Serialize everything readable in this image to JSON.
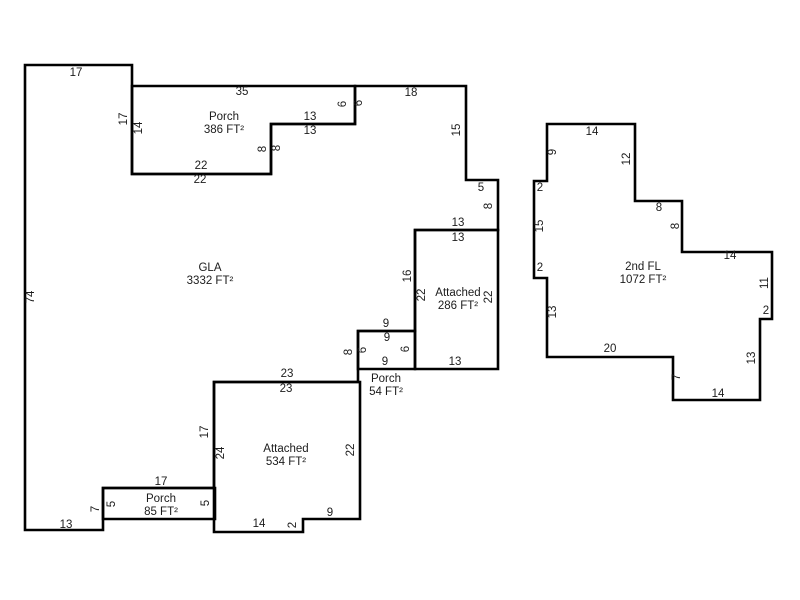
{
  "canvas": {
    "width": 800,
    "height": 600,
    "background_color": "#ffffff",
    "line_color": "#000000",
    "line_width": 2.6,
    "text_color": "#1c1c1c",
    "area_label_line_height": 13
  },
  "sketch": {
    "description": "Appraisal floor plan sketch with labeled wall dimensions in feet",
    "polygons": [
      {
        "id": "gla",
        "area_label": {
          "lines": [
            "GLA",
            "3332 FT²"
          ],
          "x": 210,
          "y": 268
        },
        "points": [
          [
            25,
            65
          ],
          [
            132,
            65
          ],
          [
            132,
            174
          ],
          [
            271,
            174
          ],
          [
            271,
            124
          ],
          [
            355,
            124
          ],
          [
            355,
            86
          ],
          [
            466,
            86
          ],
          [
            466,
            180
          ],
          [
            498,
            180
          ],
          [
            498,
            230
          ],
          [
            415,
            230
          ],
          [
            415,
            331
          ],
          [
            358,
            331
          ],
          [
            358,
            382
          ],
          [
            214,
            382
          ],
          [
            214,
            488
          ],
          [
            103,
            488
          ],
          [
            103,
            530
          ],
          [
            25,
            530
          ]
        ]
      },
      {
        "id": "porch-386",
        "area_label": {
          "lines": [
            "Porch",
            "386 FT²"
          ],
          "x": 224,
          "y": 117
        },
        "points": [
          [
            132,
            86
          ],
          [
            355,
            86
          ],
          [
            355,
            124
          ],
          [
            271,
            124
          ],
          [
            271,
            174
          ],
          [
            132,
            174
          ]
        ]
      },
      {
        "id": "attached-286",
        "area_label": {
          "lines": [
            "Attached",
            "286 FT²"
          ],
          "x": 458,
          "y": 293
        },
        "points": [
          [
            415,
            230
          ],
          [
            498,
            230
          ],
          [
            498,
            369
          ],
          [
            415,
            369
          ]
        ]
      },
      {
        "id": "porch-54",
        "area_label": {
          "lines": [
            "Porch",
            "54 FT²"
          ],
          "x": 386,
          "y": 379
        },
        "points": [
          [
            358,
            331
          ],
          [
            415,
            331
          ],
          [
            415,
            369
          ],
          [
            358,
            369
          ]
        ]
      },
      {
        "id": "attached-534",
        "area_label": {
          "lines": [
            "Attached",
            "534 FT²"
          ],
          "x": 286,
          "y": 449
        },
        "points": [
          [
            214,
            382
          ],
          [
            360,
            382
          ],
          [
            360,
            519
          ],
          [
            303,
            519
          ],
          [
            303,
            532
          ],
          [
            214,
            532
          ]
        ]
      },
      {
        "id": "porch-85",
        "area_label": {
          "lines": [
            "Porch",
            "85 FT²"
          ],
          "x": 161,
          "y": 499
        },
        "points": [
          [
            103,
            488
          ],
          [
            215,
            488
          ],
          [
            215,
            519
          ],
          [
            103,
            519
          ]
        ]
      },
      {
        "id": "second-floor",
        "area_label": {
          "lines": [
            "2nd FL",
            "1072 FT²"
          ],
          "x": 643,
          "y": 267
        },
        "points": [
          [
            547,
            124
          ],
          [
            635,
            124
          ],
          [
            635,
            201
          ],
          [
            682,
            201
          ],
          [
            682,
            252
          ],
          [
            772,
            252
          ],
          [
            772,
            319
          ],
          [
            760,
            319
          ],
          [
            760,
            400
          ],
          [
            673,
            400
          ],
          [
            673,
            357
          ],
          [
            547,
            357
          ],
          [
            547,
            278
          ],
          [
            534,
            278
          ],
          [
            534,
            181
          ],
          [
            547,
            181
          ]
        ]
      }
    ],
    "dimension_labels": [
      {
        "text": "17",
        "x": 76,
        "y": 73,
        "rotated": false
      },
      {
        "text": "74",
        "x": 31,
        "y": 297,
        "rotated": true
      },
      {
        "text": "17",
        "x": 124,
        "y": 119,
        "rotated": true
      },
      {
        "text": "14",
        "x": 139,
        "y": 128,
        "rotated": true
      },
      {
        "text": "35",
        "x": 242,
        "y": 92,
        "rotated": false
      },
      {
        "text": "13",
        "x": 310,
        "y": 117,
        "rotated": false
      },
      {
        "text": "13",
        "x": 310,
        "y": 131,
        "rotated": false
      },
      {
        "text": "6",
        "x": 343,
        "y": 104,
        "rotated": true
      },
      {
        "text": "6",
        "x": 359,
        "y": 103,
        "rotated": true
      },
      {
        "text": "8",
        "x": 263,
        "y": 149,
        "rotated": true
      },
      {
        "text": "8",
        "x": 277,
        "y": 148,
        "rotated": true
      },
      {
        "text": "22",
        "x": 201,
        "y": 166,
        "rotated": false
      },
      {
        "text": "22",
        "x": 200,
        "y": 180,
        "rotated": false
      },
      {
        "text": "18",
        "x": 411,
        "y": 93,
        "rotated": false
      },
      {
        "text": "15",
        "x": 457,
        "y": 130,
        "rotated": true
      },
      {
        "text": "5",
        "x": 481,
        "y": 188,
        "rotated": false
      },
      {
        "text": "8",
        "x": 489,
        "y": 206,
        "rotated": true
      },
      {
        "text": "13",
        "x": 458,
        "y": 223,
        "rotated": false
      },
      {
        "text": "13",
        "x": 458,
        "y": 238,
        "rotated": false
      },
      {
        "text": "16",
        "x": 408,
        "y": 276,
        "rotated": true
      },
      {
        "text": "22",
        "x": 422,
        "y": 295,
        "rotated": true
      },
      {
        "text": "22",
        "x": 489,
        "y": 297,
        "rotated": true
      },
      {
        "text": "9",
        "x": 386,
        "y": 324,
        "rotated": false
      },
      {
        "text": "9",
        "x": 387,
        "y": 338,
        "rotated": false
      },
      {
        "text": "8",
        "x": 349,
        "y": 352,
        "rotated": true
      },
      {
        "text": "6",
        "x": 363,
        "y": 350,
        "rotated": true
      },
      {
        "text": "6",
        "x": 406,
        "y": 349,
        "rotated": true
      },
      {
        "text": "9",
        "x": 385,
        "y": 362,
        "rotated": false
      },
      {
        "text": "13",
        "x": 455,
        "y": 362,
        "rotated": false
      },
      {
        "text": "23",
        "x": 287,
        "y": 374,
        "rotated": false
      },
      {
        "text": "23",
        "x": 286,
        "y": 389,
        "rotated": false
      },
      {
        "text": "17",
        "x": 205,
        "y": 432,
        "rotated": true
      },
      {
        "text": "24",
        "x": 221,
        "y": 453,
        "rotated": true
      },
      {
        "text": "22",
        "x": 351,
        "y": 450,
        "rotated": true
      },
      {
        "text": "9",
        "x": 330,
        "y": 513,
        "rotated": false
      },
      {
        "text": "2",
        "x": 293,
        "y": 525,
        "rotated": true
      },
      {
        "text": "14",
        "x": 259,
        "y": 524,
        "rotated": false
      },
      {
        "text": "17",
        "x": 161,
        "y": 482,
        "rotated": false
      },
      {
        "text": "7",
        "x": 96,
        "y": 509,
        "rotated": true
      },
      {
        "text": "5",
        "x": 112,
        "y": 504,
        "rotated": true
      },
      {
        "text": "5",
        "x": 206,
        "y": 503,
        "rotated": true
      },
      {
        "text": "13",
        "x": 66,
        "y": 525,
        "rotated": false
      },
      {
        "text": "14",
        "x": 592,
        "y": 132,
        "rotated": false
      },
      {
        "text": "9",
        "x": 553,
        "y": 152,
        "rotated": true
      },
      {
        "text": "12",
        "x": 627,
        "y": 159,
        "rotated": true
      },
      {
        "text": "2",
        "x": 540,
        "y": 188,
        "rotated": false
      },
      {
        "text": "15",
        "x": 540,
        "y": 226,
        "rotated": true
      },
      {
        "text": "8",
        "x": 659,
        "y": 208,
        "rotated": false
      },
      {
        "text": "8",
        "x": 676,
        "y": 226,
        "rotated": true
      },
      {
        "text": "14",
        "x": 730,
        "y": 256,
        "rotated": false
      },
      {
        "text": "11",
        "x": 765,
        "y": 283,
        "rotated": true
      },
      {
        "text": "2",
        "x": 766,
        "y": 311,
        "rotated": false
      },
      {
        "text": "13",
        "x": 752,
        "y": 358,
        "rotated": true
      },
      {
        "text": "14",
        "x": 718,
        "y": 394,
        "rotated": false
      },
      {
        "text": "7",
        "x": 677,
        "y": 377,
        "rotated": true
      },
      {
        "text": "20",
        "x": 610,
        "y": 349,
        "rotated": false
      },
      {
        "text": "13",
        "x": 553,
        "y": 312,
        "rotated": true
      },
      {
        "text": "2",
        "x": 540,
        "y": 268,
        "rotated": false
      }
    ]
  }
}
